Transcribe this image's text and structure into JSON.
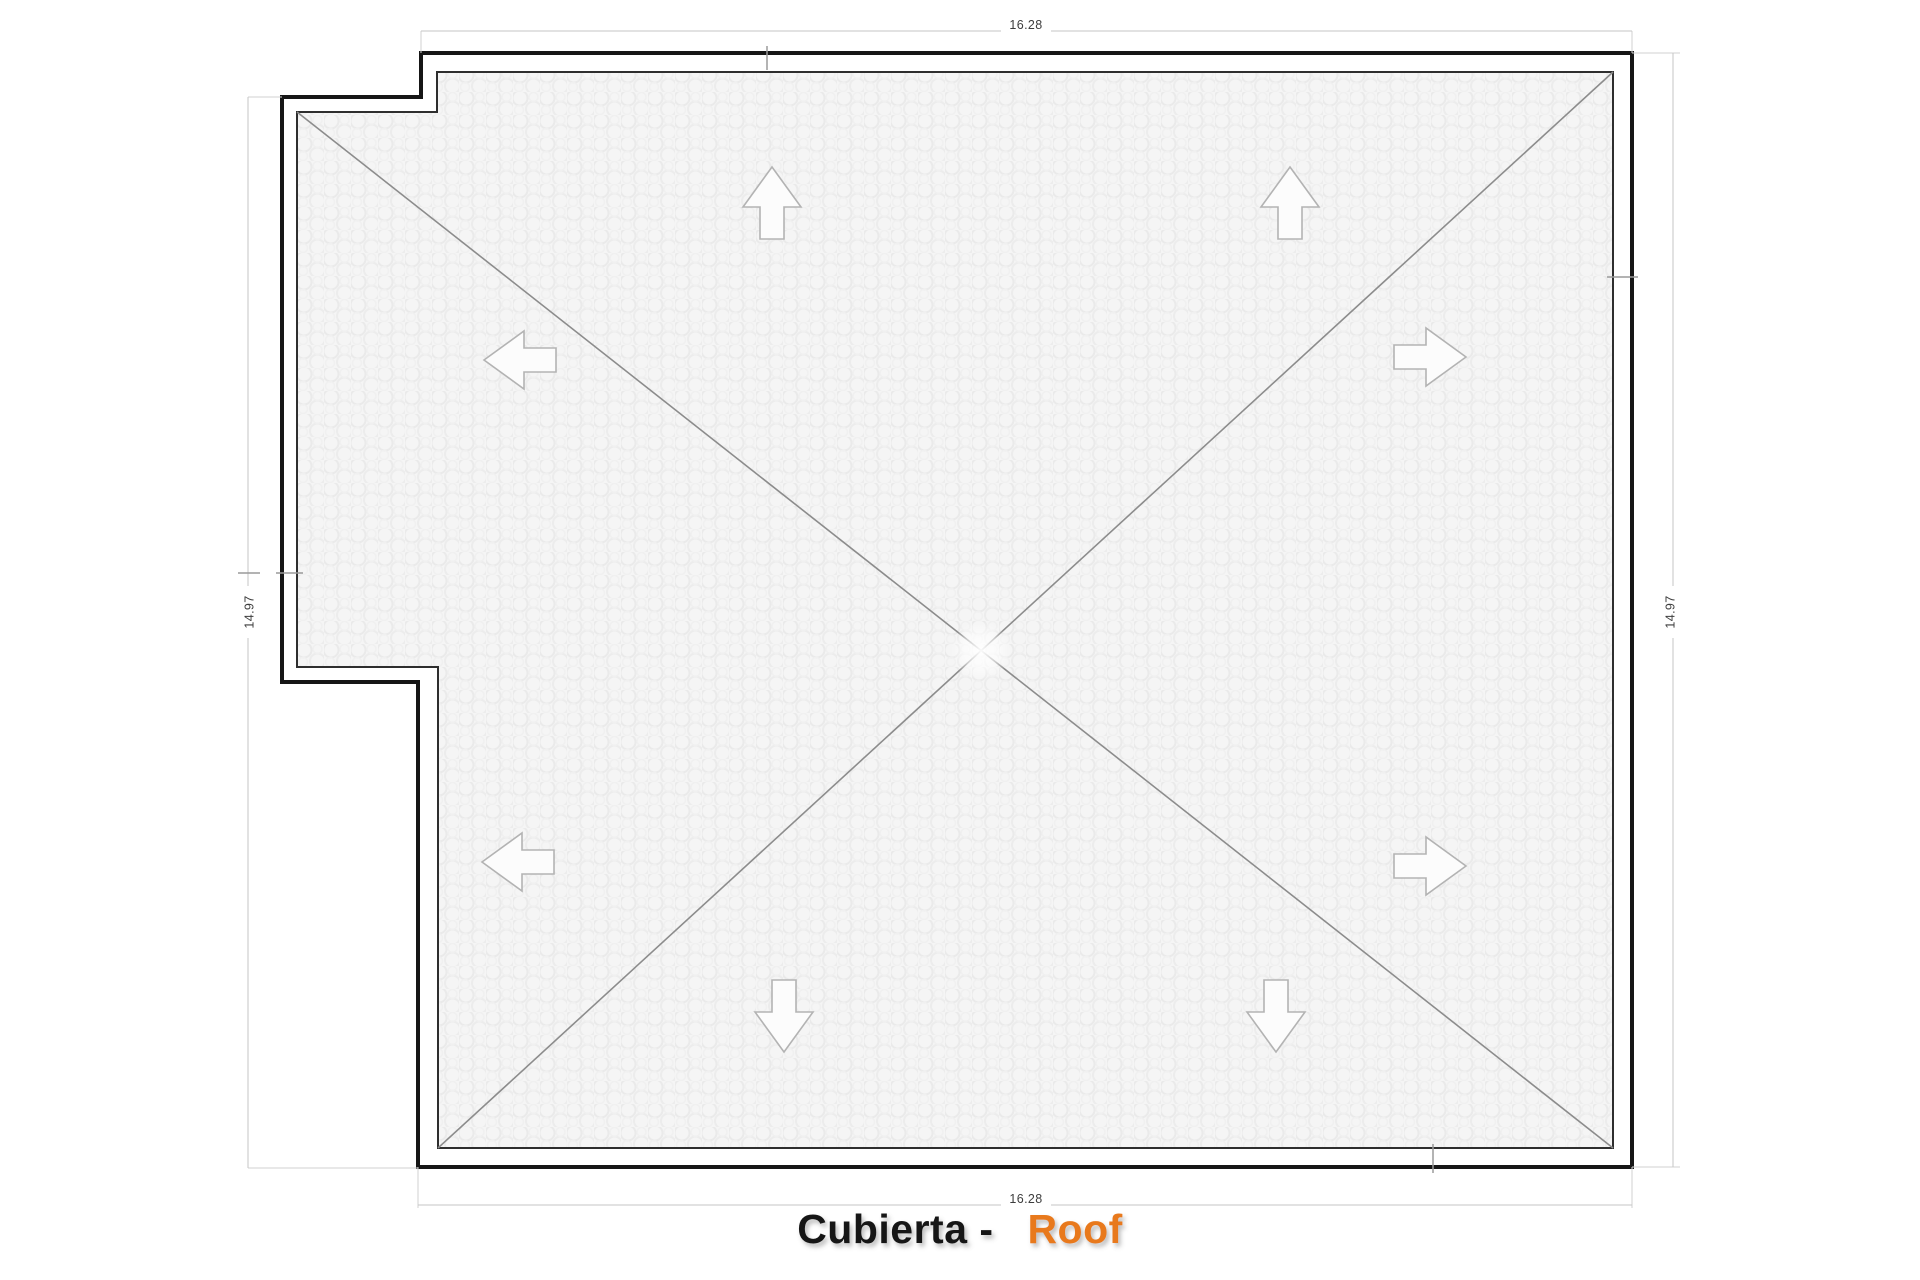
{
  "drawing": {
    "type": "roof-plan",
    "title": {
      "part1": "Cubierta -",
      "part2": "Roof",
      "accent_color": "#e8791d",
      "main_color": "#141414"
    },
    "dimensions": {
      "top": "16.28",
      "bottom": "16.28",
      "left": "14.97",
      "right": "14.97"
    },
    "slope_arrows": [
      {
        "name": "slope-arrow-up-1",
        "direction": "up"
      },
      {
        "name": "slope-arrow-up-2",
        "direction": "up"
      },
      {
        "name": "slope-arrow-right-1",
        "direction": "right"
      },
      {
        "name": "slope-arrow-right-2",
        "direction": "right"
      },
      {
        "name": "slope-arrow-down-1",
        "direction": "down"
      },
      {
        "name": "slope-arrow-down-2",
        "direction": "down"
      },
      {
        "name": "slope-arrow-left-1",
        "direction": "left"
      },
      {
        "name": "slope-arrow-left-2",
        "direction": "left"
      }
    ],
    "colors": {
      "wall_outline": "#161616",
      "roof_edge": "#2e2e2e",
      "hip_line": "#8c8c8c",
      "dimension_line": "#c6c6c6",
      "extension_line": "#d2d2d2",
      "dimension_text": "#3d3d3d",
      "arrow_outline": "#b3b3b3",
      "roof_fill": "#f5f5f5"
    }
  }
}
